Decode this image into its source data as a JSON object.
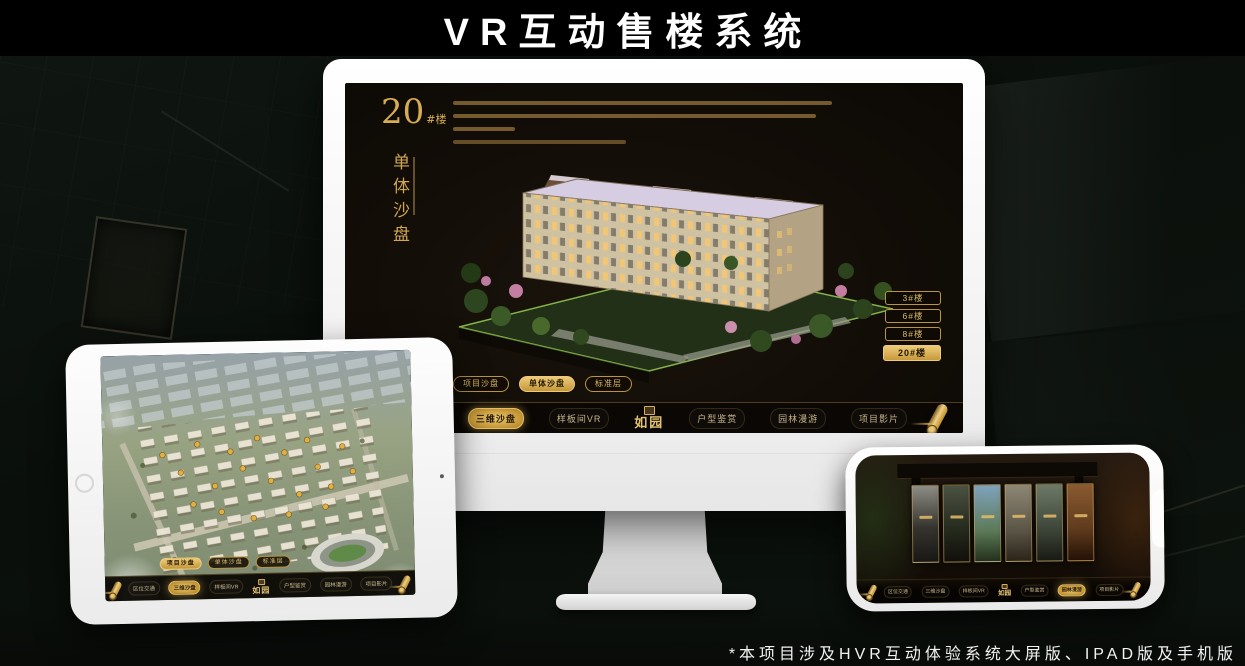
{
  "page": {
    "title": "VR互动售楼系统",
    "footnote": "*本项目涉及HVR互动体验系统大屏版、IPAD版及手机版"
  },
  "colors": {
    "gold": "#d7a94b",
    "gold_deep": "#9a7a2e",
    "screen_bg": "#14100a"
  },
  "app": {
    "logo": "如园",
    "nav_items": [
      {
        "label": "区位交通"
      },
      {
        "label": "三维沙盘"
      },
      {
        "label": "样板间VR"
      },
      {
        "label": "户型鉴赏"
      },
      {
        "label": "园林漫游"
      },
      {
        "label": "项目影片"
      }
    ]
  },
  "desktop": {
    "building_no": "20",
    "building_no_suffix": "#楼",
    "panel_title": "单体沙盘",
    "floor_buttons": [
      {
        "label": "3#楼",
        "active": false
      },
      {
        "label": "6#楼",
        "active": false
      },
      {
        "label": "8#楼",
        "active": false
      },
      {
        "label": "20#楼",
        "active": true
      }
    ],
    "sub_tabs": [
      {
        "label": "项目沙盘",
        "active": false
      },
      {
        "label": "单体沙盘",
        "active": true
      },
      {
        "label": "标准层",
        "active": false
      }
    ],
    "active_nav": "三维沙盘"
  },
  "tablet": {
    "sub_tabs": [
      {
        "label": "项目沙盘",
        "active": true
      },
      {
        "label": "单体沙盘",
        "active": false
      },
      {
        "label": "标准层",
        "active": false
      }
    ],
    "active_nav": "三维沙盘"
  },
  "phone": {
    "active_nav": "园林漫游",
    "gallery_panel_count": 6
  }
}
